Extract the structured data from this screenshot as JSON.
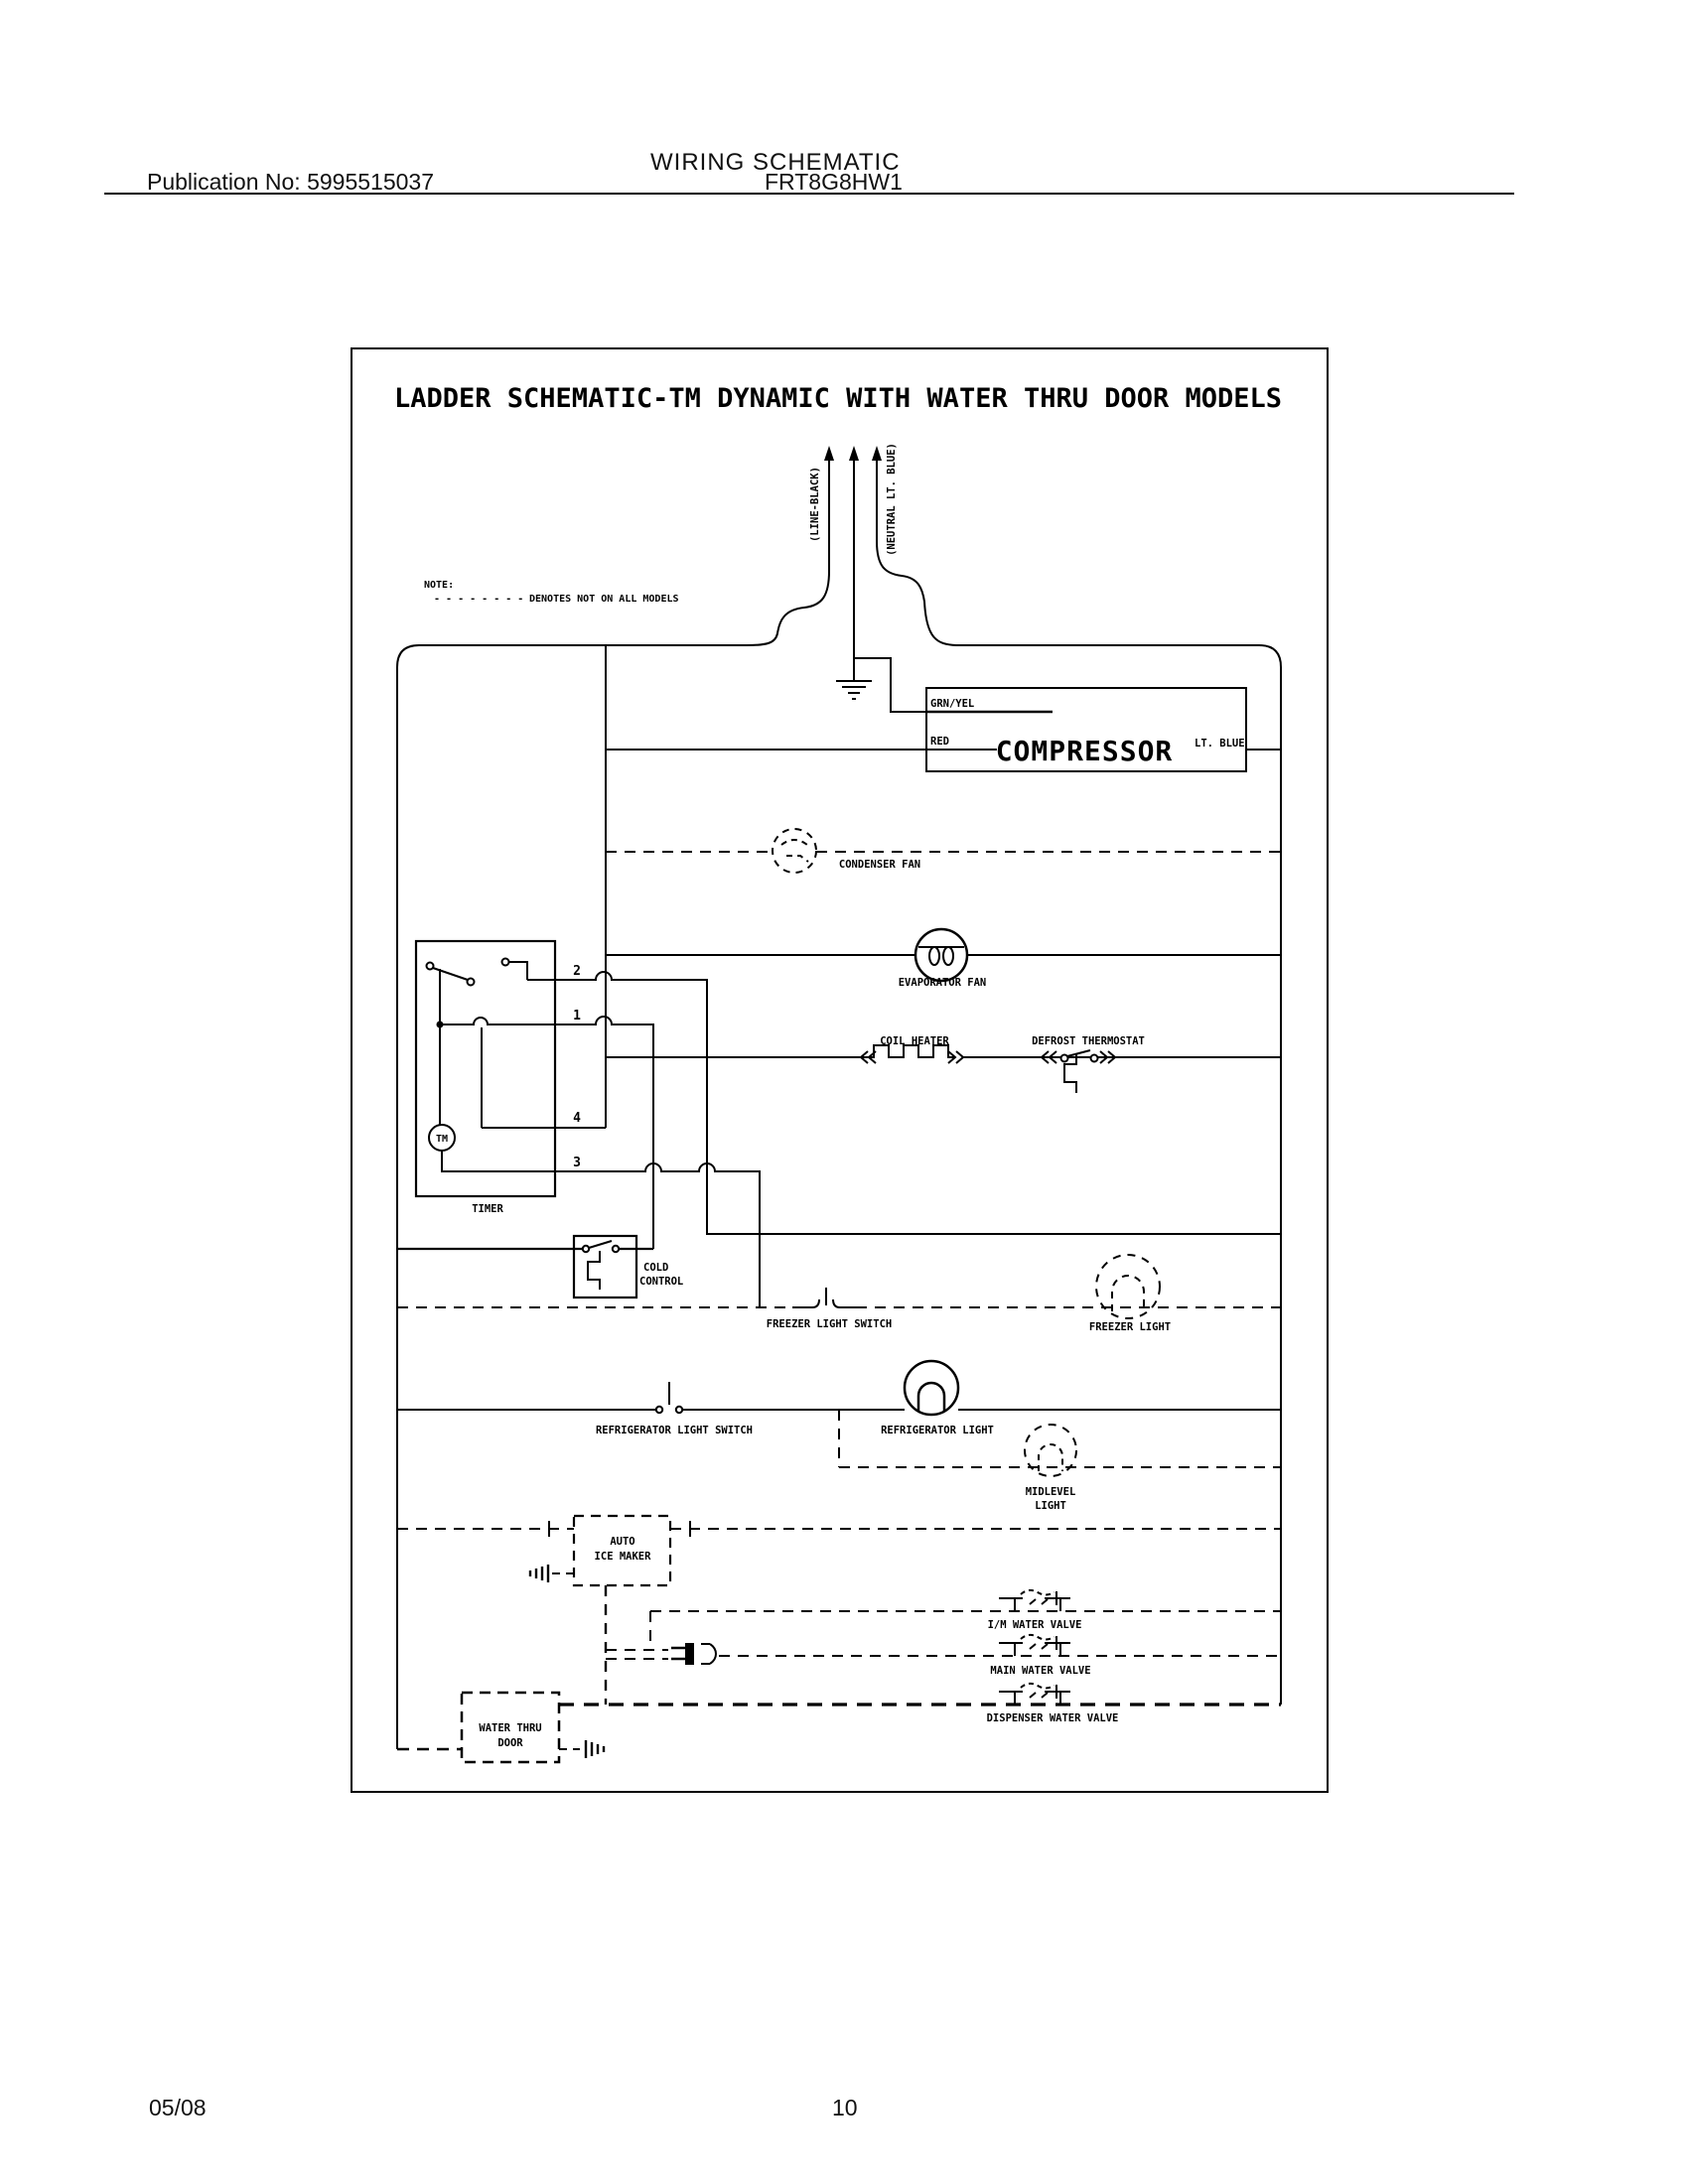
{
  "header": {
    "publication": "Publication No: 5995515037",
    "model": "FRT8G8HW1",
    "section_title": "WIRING SCHEMATIC"
  },
  "footer": {
    "date": "05/08",
    "page": "10"
  },
  "diagram": {
    "title": "LADDER SCHEMATIC-TM DYNAMIC WITH WATER THRU DOOR MODELS",
    "note": {
      "label": "NOTE:",
      "dashes": "- - - - - - - -",
      "text": "DENOTES NOT ON ALL MODELS"
    },
    "power": {
      "line": "(LINE-BLACK)",
      "neutral": "(NEUTRAL LT. BLUE)"
    },
    "compressor": {
      "name": "COMPRESSOR",
      "wire_top": "GRN/YEL",
      "wire_left": "RED",
      "wire_right": "LT. BLUE"
    },
    "components": {
      "condenser_fan": "CONDENSER FAN",
      "evaporator_fan": "EVAPORATOR FAN",
      "coil_heater": "COIL HEATER",
      "defrost_thermostat": "DEFROST THERMOSTAT",
      "timer": "TIMER",
      "timer_motor": "TM",
      "cold_control_1": "COLD",
      "cold_control_2": "CONTROL",
      "freezer_light_switch": "FREEZER LIGHT SWITCH",
      "freezer_light": "FREEZER LIGHT",
      "refrigerator_light_switch": "REFRIGERATOR LIGHT SWITCH",
      "refrigerator_light": "REFRIGERATOR LIGHT",
      "midlevel_light_1": "MIDLEVEL",
      "midlevel_light_2": "LIGHT",
      "auto_ice_maker_1": "AUTO",
      "auto_ice_maker_2": "ICE MAKER",
      "im_water_valve": "I/M WATER VALVE",
      "main_water_valve": "MAIN WATER VALVE",
      "dispenser_water_valve": "DISPENSER WATER VALVE",
      "water_thru_door_1": "WATER THRU",
      "water_thru_door_2": "DOOR"
    },
    "timer_terminals": [
      "2",
      "1",
      "4",
      "3"
    ]
  }
}
